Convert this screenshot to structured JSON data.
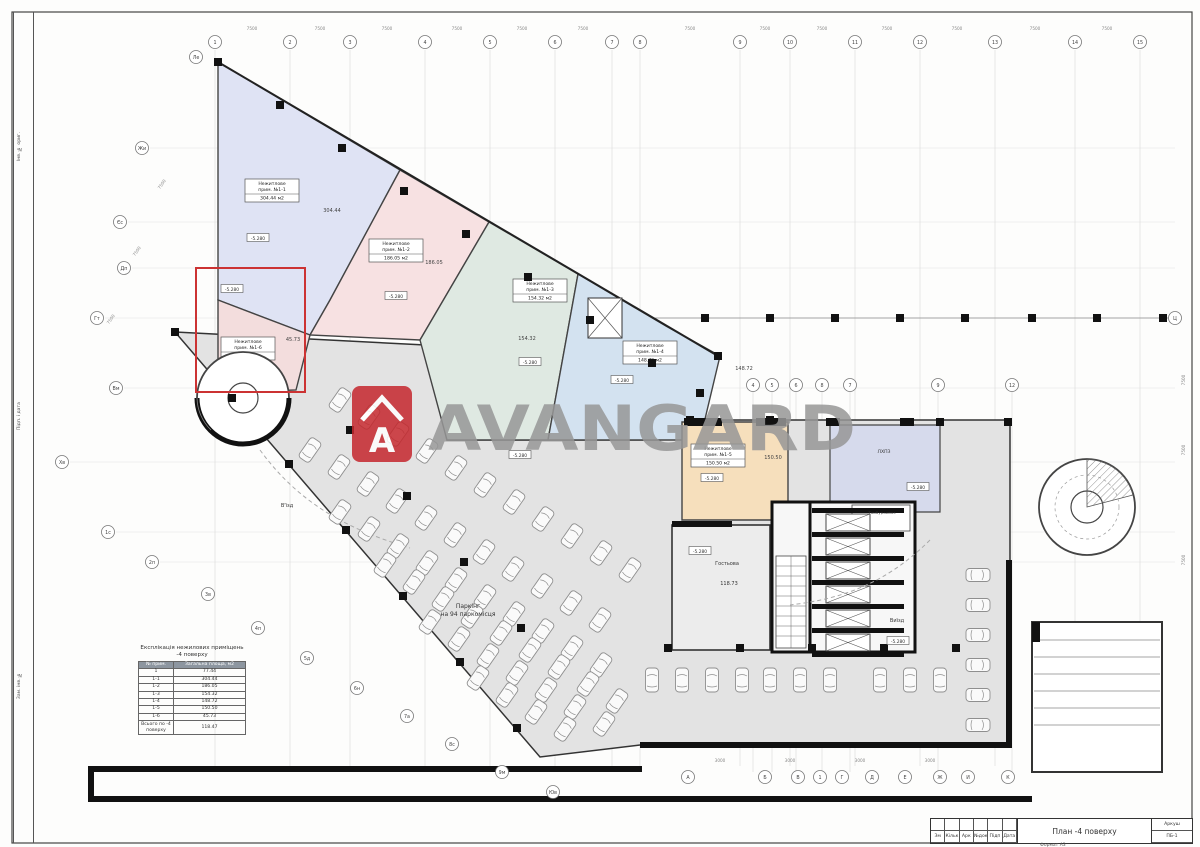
{
  "document": {
    "title": "План -4 поверху",
    "sheet_label": "Аркуш",
    "sheet_number": "ПБ-1",
    "format_note": "Формат А3",
    "stamp_cols": [
      "Зм",
      "Кільк",
      "Арк",
      "№док",
      "Підп",
      "Дата"
    ],
    "side_strip_labels": [
      "Інв. № ориг.",
      "Підп. і дата",
      "Зам. інв. №"
    ]
  },
  "watermark": {
    "text": "AVANGARD",
    "logo_letter": "A",
    "brand_red": "#c5272d",
    "gray": "#979797"
  },
  "zones": [
    {
      "id": "1-1",
      "color": "#dfe3f4",
      "polygon": [
        [
          218,
          62
        ],
        [
          400,
          170
        ],
        [
          330,
          300
        ],
        [
          310,
          335
        ],
        [
          218,
          300
        ]
      ],
      "label_lines": [
        "Нежитлове",
        "прим. №1-1"
      ],
      "area": "304.44 м2",
      "lx": 272,
      "ly": 190,
      "note": "304.44",
      "nx": 332,
      "ny": 212
    },
    {
      "id": "1-2",
      "color": "#f7e1e2",
      "polygon": [
        [
          400,
          170
        ],
        [
          489,
          222
        ],
        [
          420,
          340
        ],
        [
          310,
          335
        ],
        [
          330,
          300
        ]
      ],
      "label_lines": [
        "Нежитлове",
        "прим. №1-2"
      ],
      "area": "186.05 м2",
      "lx": 396,
      "ly": 250,
      "note": "186.05",
      "nx": 434,
      "ny": 264
    },
    {
      "id": "1-3",
      "color": "#dfe9e2",
      "polygon": [
        [
          489,
          222
        ],
        [
          578,
          274
        ],
        [
          548,
          440
        ],
        [
          447,
          440
        ],
        [
          420,
          340
        ]
      ],
      "label_lines": [
        "Нежитлове",
        "прим. №1-3"
      ],
      "area": "154.32 м2",
      "lx": 540,
      "ly": 290,
      "note": "154.32",
      "nx": 527,
      "ny": 340
    },
    {
      "id": "1-4",
      "color": "#d3e2f0",
      "polygon": [
        [
          578,
          274
        ],
        [
          666,
          326
        ],
        [
          720,
          356
        ],
        [
          700,
          440
        ],
        [
          548,
          440
        ]
      ],
      "label_lines": [
        "Нежитлове",
        "прим. №1-4"
      ],
      "area": "148.72 м2",
      "lx": 650,
      "ly": 352,
      "note": "148.72",
      "nx": 744,
      "ny": 370
    },
    {
      "id": "1-5",
      "color": "#f6dfbc",
      "polygon": [
        [
          682,
          422
        ],
        [
          788,
          422
        ],
        [
          788,
          520
        ],
        [
          682,
          520
        ]
      ],
      "label_lines": [
        "Нежитлове",
        "прим. №1-5"
      ],
      "area": "150.50 м2",
      "lx": 718,
      "ly": 455,
      "note": "150.50",
      "nx": 773,
      "ny": 459
    },
    {
      "id": "1-6",
      "color": "#f3dddd",
      "polygon": [
        [
          218,
          300
        ],
        [
          310,
          335
        ],
        [
          296,
          390
        ],
        [
          240,
          392
        ],
        [
          218,
          368
        ]
      ],
      "label_lines": [
        "Нежитлове",
        "прим. №1-6"
      ],
      "area": "45.73 м2",
      "lx": 248,
      "ly": 348,
      "note": "45.73",
      "nx": 293,
      "ny": 341
    }
  ],
  "rooms": [
    {
      "name": "lift-hall",
      "color": "#d6daec",
      "polygon": [
        [
          830,
          425
        ],
        [
          940,
          425
        ],
        [
          940,
          512
        ],
        [
          830,
          512
        ]
      ]
    }
  ],
  "elevations": [
    {
      "text": "-5.280",
      "x": 258,
      "y": 238
    },
    {
      "text": "-5.280",
      "x": 396,
      "y": 296
    },
    {
      "text": "-5.280",
      "x": 530,
      "y": 362
    },
    {
      "text": "-5.280",
      "x": 622,
      "y": 380
    },
    {
      "text": "-5.280",
      "x": 712,
      "y": 478
    },
    {
      "text": "-5.280",
      "x": 918,
      "y": 487
    },
    {
      "text": "-5.280",
      "x": 700,
      "y": 551
    },
    {
      "text": "-5.280",
      "x": 898,
      "y": 641
    },
    {
      "text": "-5.280",
      "x": 520,
      "y": 455
    },
    {
      "text": "-5.280",
      "x": 232,
      "y": 289
    }
  ],
  "labels": [
    {
      "t": "Паркінг",
      "x": 468,
      "y": 608,
      "fs": 6
    },
    {
      "t": "на 94 паркомісця",
      "x": 468,
      "y": 616,
      "fs": 6
    },
    {
      "t": "В'їзд",
      "x": 287,
      "y": 507,
      "fs": 5
    },
    {
      "t": "Виїзд",
      "x": 897,
      "y": 622,
      "fs": 5
    },
    {
      "t": "Гостьова",
      "x": 727,
      "y": 565,
      "fs": 5
    },
    {
      "t": "118.73",
      "x": 729,
      "y": 585,
      "fs": 5
    },
    {
      "t": "ЛХПЗ",
      "x": 884,
      "y": 453,
      "fs": 4.6
    },
    {
      "t": "Тамбур-шлюз",
      "x": 882,
      "y": 514,
      "fs": 3.8
    }
  ],
  "table": {
    "title_line1": "Експлікація нежилових приміщень",
    "title_line2": "-4 поверху",
    "col1": "№ прим.",
    "col2": "Загальна площа, м2",
    "rows": [
      [
        "1",
        "77.44"
      ],
      [
        "1-1",
        "304.44"
      ],
      [
        "1-2",
        "186.05"
      ],
      [
        "1-3",
        "154.32"
      ],
      [
        "1-4",
        "148.72"
      ],
      [
        "1-5",
        "150.50"
      ],
      [
        "1-6",
        "45.73"
      ]
    ],
    "total_label": "Всього по -4 поверху",
    "total_value": "118.47"
  },
  "axes": {
    "top": [
      {
        "x": 215,
        "l": "1"
      },
      {
        "x": 290,
        "l": "2"
      },
      {
        "x": 350,
        "l": "3"
      },
      {
        "x": 425,
        "l": "4"
      },
      {
        "x": 490,
        "l": "5"
      },
      {
        "x": 555,
        "l": "6"
      },
      {
        "x": 612,
        "l": "7"
      },
      {
        "x": 640,
        "l": "8"
      },
      {
        "x": 740,
        "l": "9"
      },
      {
        "x": 790,
        "l": "10"
      },
      {
        "x": 855,
        "l": "11"
      },
      {
        "x": 920,
        "l": "12"
      },
      {
        "x": 995,
        "l": "13"
      },
      {
        "x": 1075,
        "l": "14"
      },
      {
        "x": 1140,
        "l": "15"
      }
    ],
    "left": [
      {
        "x": 142,
        "y": 148,
        "l": "Жи"
      },
      {
        "x": 120,
        "y": 222,
        "l": "Єс"
      },
      {
        "x": 124,
        "y": 268,
        "l": "Дп"
      },
      {
        "x": 97,
        "y": 318,
        "l": "Гт"
      },
      {
        "x": 116,
        "y": 388,
        "l": "Вм"
      },
      {
        "x": 62,
        "y": 462,
        "l": "Хв"
      },
      {
        "x": 108,
        "y": 532,
        "l": "1с"
      },
      {
        "x": 152,
        "y": 562,
        "l": "2п"
      }
    ],
    "diag": [
      {
        "x": 196,
        "y": 57,
        "l": "Ле"
      },
      {
        "x": 208,
        "y": 594,
        "l": "3в"
      },
      {
        "x": 258,
        "y": 628,
        "l": "4п"
      },
      {
        "x": 307,
        "y": 658,
        "l": "5д"
      },
      {
        "x": 357,
        "y": 688,
        "l": "6н"
      },
      {
        "x": 407,
        "y": 716,
        "l": "7а"
      },
      {
        "x": 452,
        "y": 744,
        "l": "8с"
      },
      {
        "x": 502,
        "y": 772,
        "l": "9м"
      },
      {
        "x": 553,
        "y": 792,
        "l": "Юв"
      }
    ],
    "mid": [
      {
        "x": 753,
        "y": 385,
        "l": "4"
      },
      {
        "x": 772,
        "y": 385,
        "l": "5"
      },
      {
        "x": 796,
        "y": 385,
        "l": "6"
      },
      {
        "x": 822,
        "y": 385,
        "l": "8"
      },
      {
        "x": 850,
        "y": 385,
        "l": "7"
      },
      {
        "x": 938,
        "y": 385,
        "l": "9"
      },
      {
        "x": 1012,
        "y": 385,
        "l": "12"
      }
    ],
    "bottom": [
      {
        "x": 688,
        "y": 777,
        "l": "А"
      },
      {
        "x": 765,
        "y": 777,
        "l": "Б"
      },
      {
        "x": 798,
        "y": 777,
        "l": "В"
      },
      {
        "x": 820,
        "y": 777,
        "l": "1"
      },
      {
        "x": 842,
        "y": 777,
        "l": "Г"
      },
      {
        "x": 872,
        "y": 777,
        "l": "Д"
      },
      {
        "x": 905,
        "y": 777,
        "l": "Е"
      },
      {
        "x": 940,
        "y": 777,
        "l": "Ж"
      },
      {
        "x": 968,
        "y": 777,
        "l": "И"
      },
      {
        "x": 1008,
        "y": 777,
        "l": "К"
      }
    ],
    "right": [
      {
        "x": 1175,
        "y": 318,
        "l": "Ц"
      }
    ]
  },
  "columns_px": [
    [
      218,
      62
    ],
    [
      280,
      105
    ],
    [
      342,
      148
    ],
    [
      404,
      191
    ],
    [
      466,
      234
    ],
    [
      528,
      277
    ],
    [
      590,
      320
    ],
    [
      652,
      363
    ],
    [
      700,
      393
    ],
    [
      718,
      356
    ],
    [
      705,
      318
    ],
    [
      770,
      318
    ],
    [
      835,
      318
    ],
    [
      900,
      318
    ],
    [
      965,
      318
    ],
    [
      1032,
      318
    ],
    [
      1097,
      318
    ],
    [
      1163,
      318
    ],
    [
      175,
      332
    ],
    [
      232,
      398
    ],
    [
      289,
      464
    ],
    [
      346,
      530
    ],
    [
      403,
      596
    ],
    [
      460,
      662
    ],
    [
      517,
      728
    ],
    [
      350,
      430
    ],
    [
      407,
      496
    ],
    [
      464,
      562
    ],
    [
      521,
      628
    ],
    [
      668,
      648
    ],
    [
      740,
      648
    ],
    [
      812,
      648
    ],
    [
      884,
      648
    ],
    [
      956,
      648
    ],
    [
      690,
      420
    ],
    [
      770,
      420
    ],
    [
      940,
      422
    ],
    [
      1008,
      422
    ]
  ],
  "parking_rows": [
    {
      "x": 340,
      "y": 400,
      "dx": 29,
      "dy": 17,
      "n": 11,
      "a": 35
    },
    {
      "x": 310,
      "y": 450,
      "dx": 29,
      "dy": 17,
      "n": 11,
      "a": 35
    },
    {
      "x": 340,
      "y": 512,
      "dx": 29,
      "dy": 17,
      "n": 10,
      "a": 35
    },
    {
      "x": 385,
      "y": 565,
      "dx": 29,
      "dy": 17,
      "n": 9,
      "a": 35
    },
    {
      "x": 430,
      "y": 622,
      "dx": 29,
      "dy": 17,
      "n": 7,
      "a": 35
    },
    {
      "x": 478,
      "y": 678,
      "dx": 29,
      "dy": 17,
      "n": 4,
      "a": 35
    },
    {
      "x": 652,
      "y": 680,
      "dx": 30,
      "dy": 0,
      "n": 4,
      "a": 0
    },
    {
      "x": 770,
      "y": 680,
      "dx": 30,
      "dy": 0,
      "n": 3,
      "a": 0
    },
    {
      "x": 880,
      "y": 680,
      "dx": 30,
      "dy": 0,
      "n": 3,
      "a": 0
    },
    {
      "x": 978,
      "y": 575,
      "dx": 0,
      "dy": 30,
      "n": 6,
      "a": 90
    }
  ],
  "dimensions": [
    {
      "t": "7500",
      "x": 252,
      "y": 30,
      "r": 0
    },
    {
      "t": "7500",
      "x": 320,
      "y": 30,
      "r": 0
    },
    {
      "t": "7500",
      "x": 387,
      "y": 30,
      "r": 0
    },
    {
      "t": "7500",
      "x": 457,
      "y": 30,
      "r": 0
    },
    {
      "t": "7500",
      "x": 522,
      "y": 30,
      "r": 0
    },
    {
      "t": "7500",
      "x": 583,
      "y": 30,
      "r": 0
    },
    {
      "t": "7500",
      "x": 690,
      "y": 30,
      "r": 0
    },
    {
      "t": "7500",
      "x": 765,
      "y": 30,
      "r": 0
    },
    {
      "t": "7500",
      "x": 822,
      "y": 30,
      "r": 0
    },
    {
      "t": "7500",
      "x": 887,
      "y": 30,
      "r": 0
    },
    {
      "t": "7500",
      "x": 957,
      "y": 30,
      "r": 0
    },
    {
      "t": "7500",
      "x": 1035,
      "y": 30,
      "r": 0
    },
    {
      "t": "7500",
      "x": 1107,
      "y": 30,
      "r": 0
    },
    {
      "t": "7500",
      "x": 1185,
      "y": 380,
      "r": -90
    },
    {
      "t": "7500",
      "x": 1185,
      "y": 450,
      "r": -90
    },
    {
      "t": "7500",
      "x": 1185,
      "y": 560,
      "r": -90
    },
    {
      "t": "7500",
      "x": 163,
      "y": 185,
      "r": -55
    },
    {
      "t": "7500",
      "x": 138,
      "y": 252,
      "r": -55
    },
    {
      "t": "7500",
      "x": 112,
      "y": 320,
      "r": -55
    },
    {
      "t": "3000",
      "x": 720,
      "y": 762,
      "r": 0
    },
    {
      "t": "3000",
      "x": 790,
      "y": 762,
      "r": 0
    },
    {
      "t": "3000",
      "x": 860,
      "y": 762,
      "r": 0
    },
    {
      "t": "3000",
      "x": 930,
      "y": 762,
      "r": 0
    }
  ],
  "core": {
    "x": 812,
    "y": 508,
    "shafts": 6
  },
  "highlight_color": "#cc3333"
}
